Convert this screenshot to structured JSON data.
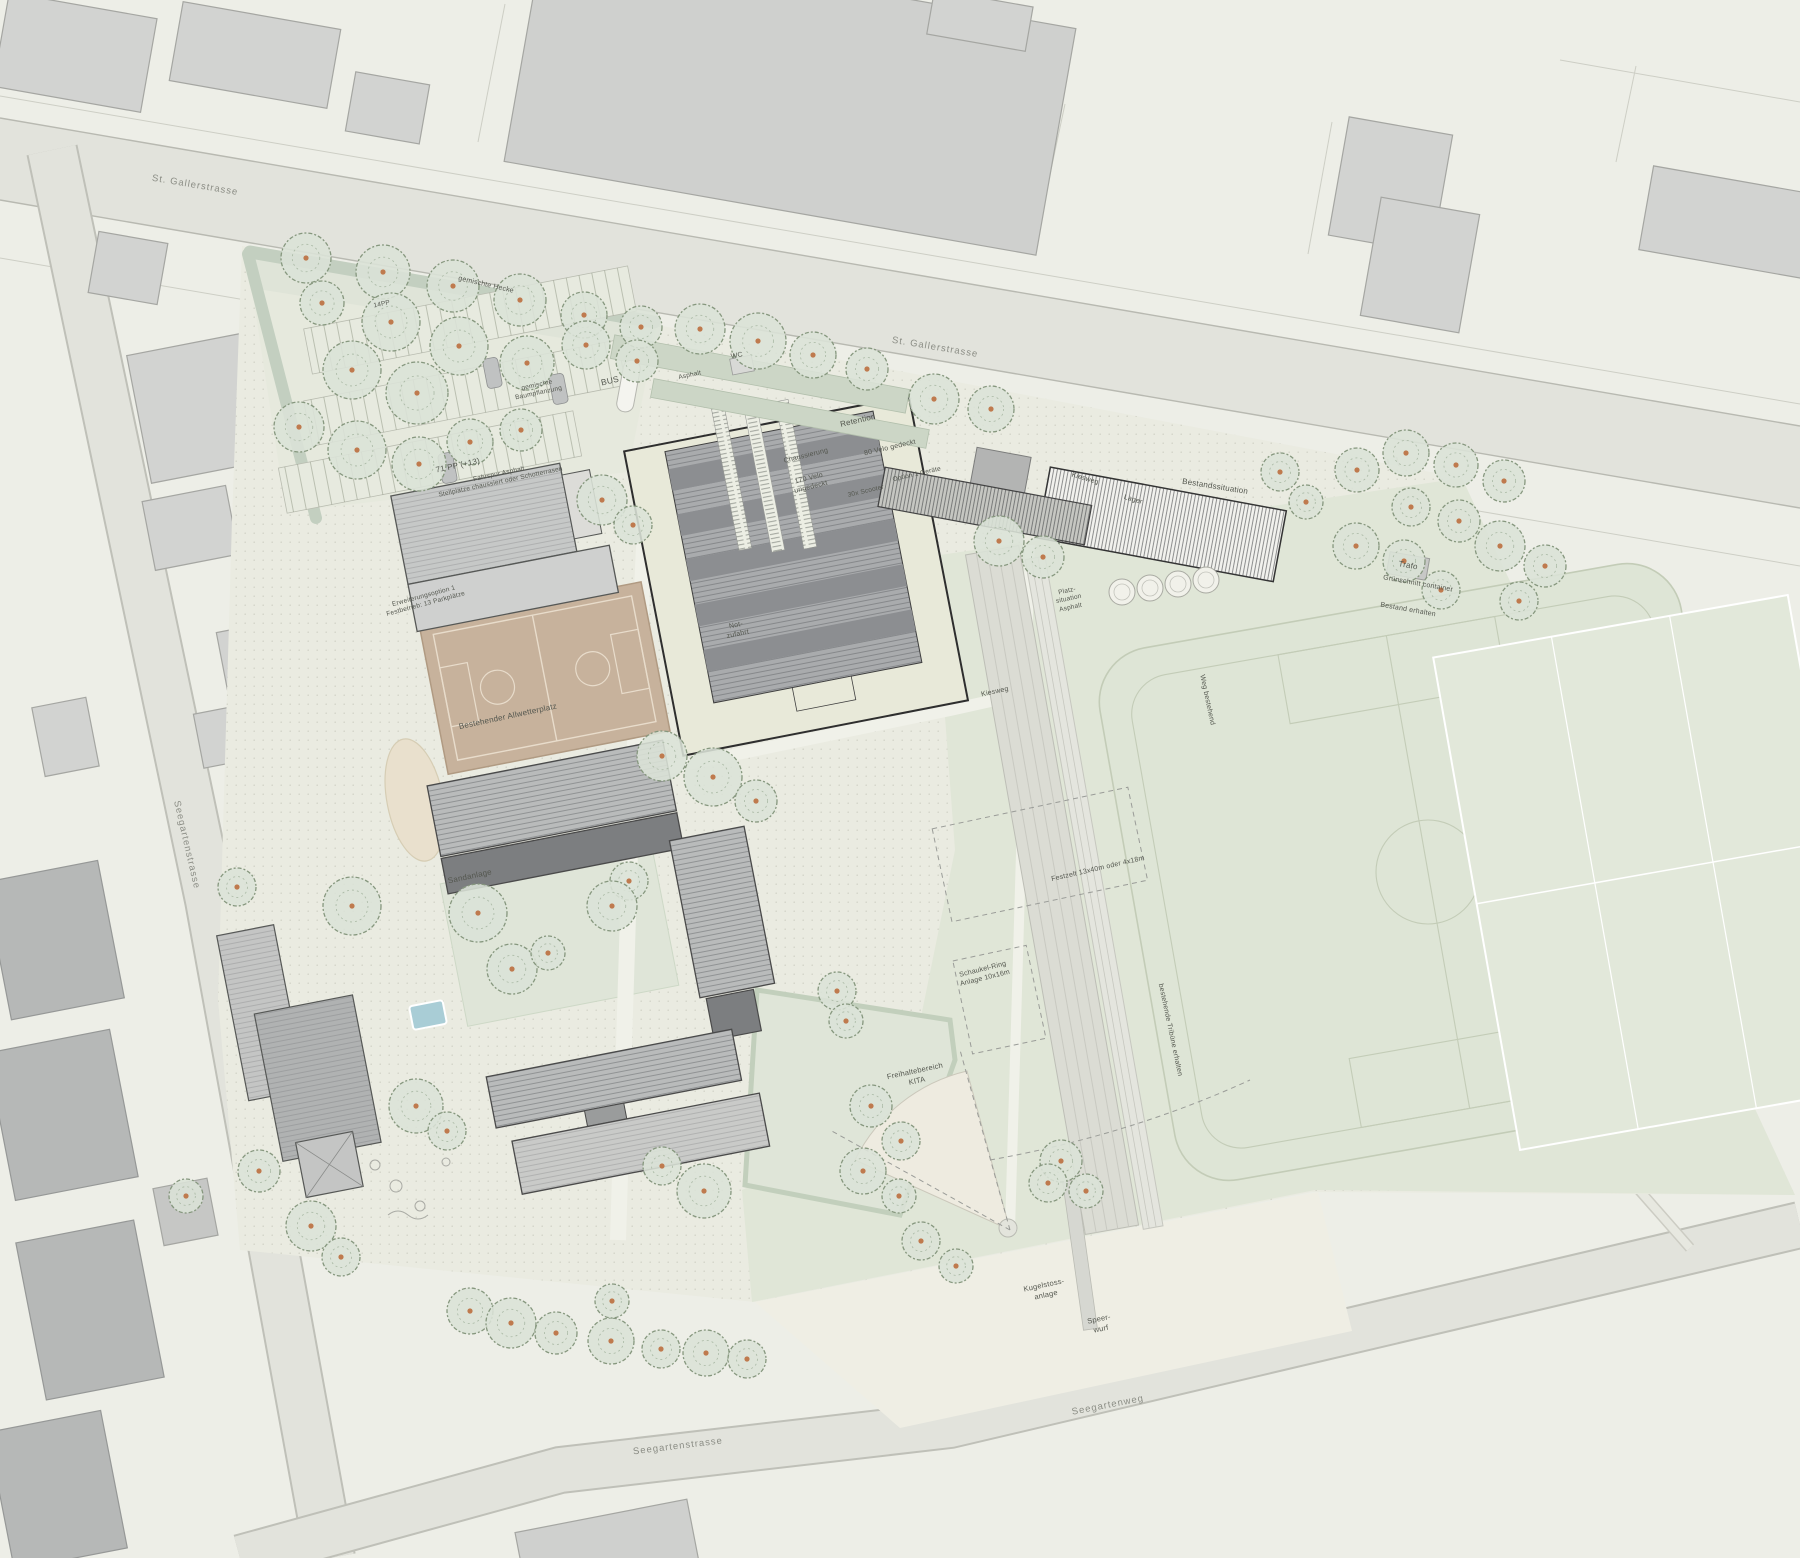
{
  "plan": {
    "type": "architectural-site-plan",
    "width": 1800,
    "height": 1558
  },
  "colors": {
    "background": "#edeee7",
    "street": "#e2e3dc",
    "street_edge": "#b8b9b1",
    "site_paving": "#eaebe1",
    "meadow_green": "#e0e6d7",
    "lawn_green": "#dfe5d8",
    "hedge_green": "#c3cfc0",
    "context_building": "#d2d3d1",
    "dark_building": "#b6b8b7",
    "roof_ribbed": "#b9bbbb",
    "roof_dark_band": "#7c7e80",
    "new_hall_footprint": "#e8e9d9",
    "new_hall_roof": "#a9abad",
    "allwetterplatz": "#c7b29c",
    "court_lines": "#e8dccb",
    "sand": "#e9e0cd",
    "pool_blue": "#a9cdd6",
    "tree_canopy": "#dbe2d7",
    "tree_edge": "#86977e",
    "tree_dot": "#bf7a4e",
    "label_text": "#54574f",
    "street_text": "#8b8d85"
  },
  "labels": [
    {
      "id": "street-st-gallerstrasse-west",
      "text": "St. Gallerstrasse",
      "x": 195,
      "y": 186,
      "rot": 9.5,
      "size": 9.5,
      "cls": "street"
    },
    {
      "id": "street-st-gallerstrasse-mid",
      "text": "St. Gallerstrasse",
      "x": 935,
      "y": 348,
      "rot": 9.5,
      "size": 9.5,
      "cls": "street"
    },
    {
      "id": "street-seegartenstrasse-west",
      "text": "Seegartenstrasse",
      "x": 186,
      "y": 845,
      "rot": 77,
      "size": 9.5,
      "cls": "street"
    },
    {
      "id": "street-seegartenstrasse-sued",
      "text": "Seegartenstrasse",
      "x": 678,
      "y": 1447,
      "rot": -7,
      "size": 9.5,
      "cls": "street"
    },
    {
      "id": "street-seegartenweg",
      "text": "Seegartenweg",
      "x": 1108,
      "y": 1406,
      "rot": -11,
      "size": 9.5,
      "cls": "street"
    },
    {
      "id": "gemischte-hecke",
      "text": "gemischte Hecke",
      "x": 486,
      "y": 285,
      "rot": 13,
      "size": 7
    },
    {
      "id": "pp14",
      "text": "14PP",
      "x": 382,
      "y": 305,
      "rot": -12,
      "size": 6.5
    },
    {
      "id": "pp71",
      "text": "71 PP (+13)",
      "x": 458,
      "y": 466,
      "rot": -12,
      "size": 8
    },
    {
      "id": "pp71-detail",
      "text": "Fahrspur Asphalt\nStellplätze chaussiert oder Schotterrasen",
      "x": 500,
      "y": 479,
      "rot": -12,
      "size": 6.5
    },
    {
      "id": "bus",
      "text": "BUS",
      "x": 610,
      "y": 381,
      "rot": -13,
      "size": 8.5
    },
    {
      "id": "gemischte-baumpflanzung",
      "text": "gemischte\nBaumpflanzung",
      "x": 538,
      "y": 390,
      "rot": -12,
      "size": 6.5
    },
    {
      "id": "wc",
      "text": "WC",
      "x": 737,
      "y": 356,
      "rot": -12,
      "size": 7
    },
    {
      "id": "asphalt",
      "text": "Asphalt",
      "x": 690,
      "y": 376,
      "rot": -12,
      "size": 6.5
    },
    {
      "id": "retention",
      "text": "Retention",
      "x": 858,
      "y": 421,
      "rot": -13,
      "size": 8
    },
    {
      "id": "chaussierung",
      "text": "Chaussierung",
      "x": 806,
      "y": 456,
      "rot": -14,
      "size": 7
    },
    {
      "id": "velo-gedeckt",
      "text": "80 Velo gedeckt",
      "x": 890,
      "y": 448,
      "rot": -13,
      "size": 7
    },
    {
      "id": "velo-ungedeckt",
      "text": "170 Velo\nungedeckt",
      "x": 810,
      "y": 483,
      "rot": -14,
      "size": 7
    },
    {
      "id": "scooter",
      "text": "30x Scooter",
      "x": 866,
      "y": 492,
      "rot": -13,
      "size": 6.5
    },
    {
      "id": "option-geraete",
      "text": "Option 1 Geräte",
      "x": 917,
      "y": 475,
      "rot": -13,
      "size": 6.5
    },
    {
      "id": "kiesweg-nord",
      "text": "Kiesweg",
      "x": 1085,
      "y": 479,
      "rot": 16,
      "size": 7
    },
    {
      "id": "lager",
      "text": "Lager",
      "x": 1133,
      "y": 500,
      "rot": 16,
      "size": 7
    },
    {
      "id": "bestandssituation",
      "text": "Bestandssituation",
      "x": 1215,
      "y": 487,
      "rot": 9,
      "size": 8
    },
    {
      "id": "trafo",
      "text": "Trafo",
      "x": 1408,
      "y": 566,
      "rot": 10,
      "size": 8
    },
    {
      "id": "gruenschnitt",
      "text": "Grünschnitt container",
      "x": 1418,
      "y": 584,
      "rot": 10,
      "size": 7
    },
    {
      "id": "bestand-erhalten",
      "text": "Bestand erhalten",
      "x": 1408,
      "y": 610,
      "rot": 10,
      "size": 7
    },
    {
      "id": "platzsituation",
      "text": "Platz-\nsituation\nAsphalt",
      "x": 1069,
      "y": 600,
      "rot": -12,
      "size": 6.5
    },
    {
      "id": "notzufahrt",
      "text": "Not-\nzufahrt",
      "x": 737,
      "y": 630,
      "rot": -12,
      "size": 7
    },
    {
      "id": "erweiterung",
      "text": "Erweiterungsoption 1\nFestbetrieb: 13 Parkplätze",
      "x": 425,
      "y": 601,
      "rot": -15,
      "size": 6.5
    },
    {
      "id": "allwetterplatz",
      "text": "Bestehender Allwetterplatz",
      "x": 508,
      "y": 717,
      "rot": -12,
      "size": 8
    },
    {
      "id": "sandanlage",
      "text": "Sandanlage",
      "x": 470,
      "y": 877,
      "rot": -12,
      "size": 8
    },
    {
      "id": "kiesweg-mitte",
      "text": "Kiesweg",
      "x": 995,
      "y": 692,
      "rot": -12,
      "size": 7
    },
    {
      "id": "weg-bestehend",
      "text": "Weg bestehend",
      "x": 1207,
      "y": 700,
      "rot": 78,
      "size": 7
    },
    {
      "id": "festzelt",
      "text": "Festzelt 13x40m oder 4x18m",
      "x": 1098,
      "y": 869,
      "rot": -13,
      "size": 7
    },
    {
      "id": "schaukel-ring",
      "text": "Schaukel-Ring\nAnlage 10x16m",
      "x": 984,
      "y": 974,
      "rot": -14,
      "size": 7
    },
    {
      "id": "tribuene",
      "text": "bestehende Tribüne erhalten",
      "x": 1170,
      "y": 1030,
      "rot": 78,
      "size": 7
    },
    {
      "id": "freihaltebereich-kita",
      "text": "Freihaltebereich\nKITA",
      "x": 916,
      "y": 1076,
      "rot": -12,
      "size": 7.5
    },
    {
      "id": "kugelstoss",
      "text": "Kugelstoss-\nanlage",
      "x": 1045,
      "y": 1290,
      "rot": -12,
      "size": 7.5
    },
    {
      "id": "speerwurf",
      "text": "Speer-\nwurf",
      "x": 1100,
      "y": 1324,
      "rot": -12,
      "size": 7.5
    }
  ],
  "trees": [
    [
      306,
      258,
      25
    ],
    [
      383,
      272,
      27
    ],
    [
      453,
      286,
      26
    ],
    [
      520,
      300,
      26
    ],
    [
      584,
      315,
      23
    ],
    [
      641,
      327,
      21
    ],
    [
      322,
      303,
      22
    ],
    [
      391,
      322,
      29
    ],
    [
      459,
      346,
      29
    ],
    [
      527,
      363,
      27
    ],
    [
      352,
      370,
      29
    ],
    [
      417,
      393,
      31
    ],
    [
      470,
      442,
      23
    ],
    [
      521,
      430,
      21
    ],
    [
      299,
      427,
      25
    ],
    [
      357,
      450,
      29
    ],
    [
      419,
      464,
      27
    ],
    [
      586,
      345,
      24
    ],
    [
      637,
      361,
      21
    ],
    [
      700,
      329,
      25
    ],
    [
      758,
      341,
      28
    ],
    [
      813,
      355,
      23
    ],
    [
      867,
      369,
      21
    ],
    [
      934,
      399,
      25
    ],
    [
      991,
      409,
      23
    ],
    [
      999,
      541,
      25
    ],
    [
      1043,
      557,
      21
    ],
    [
      1280,
      472,
      19
    ],
    [
      1306,
      502,
      17
    ],
    [
      1357,
      470,
      22
    ],
    [
      1406,
      453,
      23
    ],
    [
      1456,
      465,
      22
    ],
    [
      1504,
      481,
      21
    ],
    [
      1411,
      507,
      19
    ],
    [
      1459,
      521,
      21
    ],
    [
      1356,
      546,
      23
    ],
    [
      1404,
      561,
      21
    ],
    [
      1500,
      546,
      25
    ],
    [
      1545,
      566,
      21
    ],
    [
      1441,
      590,
      19
    ],
    [
      1519,
      601,
      19
    ],
    [
      602,
      500,
      25
    ],
    [
      633,
      525,
      19
    ],
    [
      662,
      756,
      25
    ],
    [
      713,
      777,
      29
    ],
    [
      756,
      801,
      21
    ],
    [
      629,
      881,
      19
    ],
    [
      612,
      906,
      25
    ],
    [
      478,
      913,
      29
    ],
    [
      512,
      969,
      25
    ],
    [
      548,
      953,
      17
    ],
    [
      352,
      906,
      29
    ],
    [
      237,
      887,
      19
    ],
    [
      416,
      1106,
      27
    ],
    [
      447,
      1131,
      19
    ],
    [
      704,
      1191,
      27
    ],
    [
      662,
      1166,
      19
    ],
    [
      837,
      991,
      19
    ],
    [
      846,
      1021,
      17
    ],
    [
      871,
      1106,
      21
    ],
    [
      901,
      1141,
      19
    ],
    [
      863,
      1171,
      23
    ],
    [
      899,
      1196,
      17
    ],
    [
      186,
      1196,
      17
    ],
    [
      259,
      1171,
      21
    ],
    [
      311,
      1226,
      25
    ],
    [
      341,
      1257,
      19
    ],
    [
      470,
      1311,
      23
    ],
    [
      511,
      1323,
      25
    ],
    [
      556,
      1333,
      21
    ],
    [
      611,
      1341,
      23
    ],
    [
      661,
      1349,
      19
    ],
    [
      706,
      1353,
      23
    ],
    [
      747,
      1359,
      19
    ],
    [
      612,
      1301,
      17
    ],
    [
      1061,
      1161,
      21
    ],
    [
      1086,
      1191,
      17
    ],
    [
      921,
      1241,
      19
    ],
    [
      956,
      1266,
      17
    ],
    [
      1048,
      1183,
      19
    ]
  ],
  "planters": [
    [
      1122,
      592
    ],
    [
      1150,
      588
    ],
    [
      1178,
      584
    ],
    [
      1206,
      580
    ]
  ]
}
